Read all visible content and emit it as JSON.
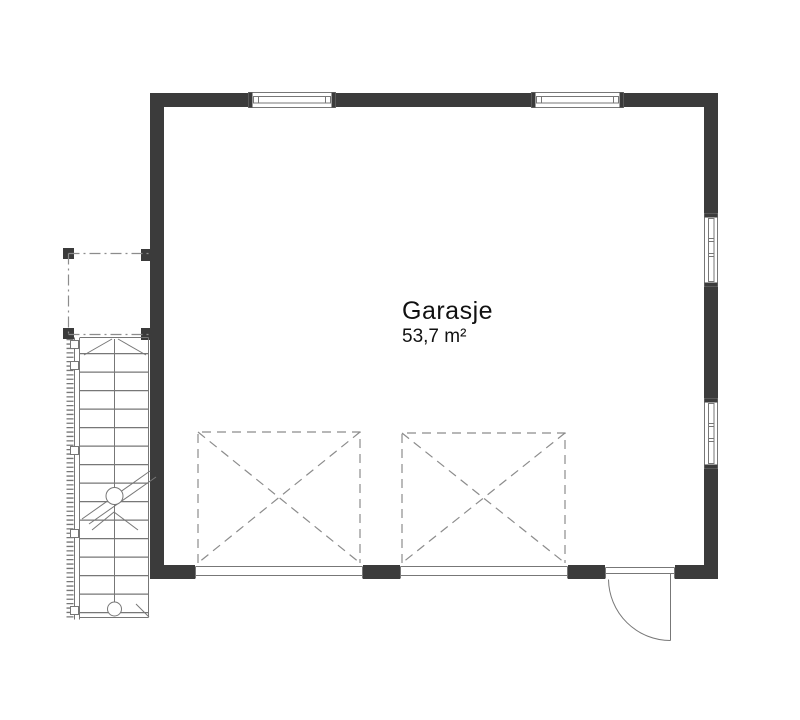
{
  "plan": {
    "room_label": "Garasje",
    "room_area": "53,7 m²"
  },
  "colors": {
    "wall": "#3b3b3b",
    "line": "#777777",
    "dash": "#8c8c8c",
    "text": "#111111",
    "background": "#ffffff"
  },
  "symbols": {
    "top_windows": [
      "window-top-left",
      "window-top-right"
    ],
    "right_windows": [
      "window-right-upper",
      "window-right-lower"
    ],
    "garage_door_zones": [
      "garage-door-zone-left",
      "garage-door-zone-right"
    ],
    "entry_door": "entry-door-swing",
    "stair": "external-stair",
    "overhang": "roof-overhang-outline"
  }
}
